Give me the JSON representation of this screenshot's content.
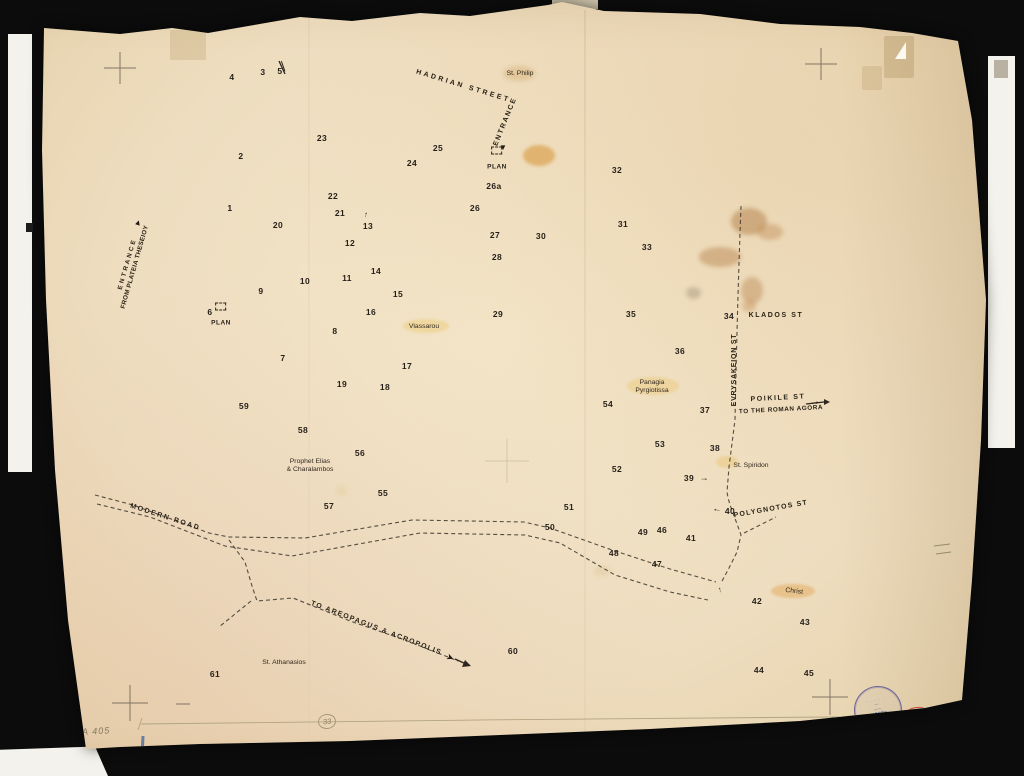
{
  "document": {
    "catalog_number": "A 405",
    "scale_circle_number": "33",
    "red_inventory_mark": "1-1",
    "stamp": {
      "bottom_text": "ATHENS",
      "handwritten_number": "1310a"
    }
  },
  "map": {
    "plan_label": "PLAN",
    "plan_markers": [
      {
        "name": "plan-marker-entrance",
        "x": 497,
        "y": 160
      },
      {
        "name": "plan-marker-6",
        "x": 221,
        "y": 316
      }
    ],
    "labels": [
      {
        "name": "street-label-hadrian",
        "kind": "street",
        "text": "HADRIAN STREET",
        "x": 463,
        "y": 87,
        "rot": 17,
        "ls": 2.6
      },
      {
        "name": "street-label-entrance-top",
        "kind": "street",
        "text": "ENTRANCE",
        "x": 506,
        "y": 122,
        "rot": -68,
        "ls": 1.6
      },
      {
        "name": "street-label-entrance-west",
        "kind": "street",
        "text": "E N T R A N C E\nFROM PLATEIA THESEIOY",
        "x": 131,
        "y": 266,
        "rot": -74,
        "ls": 0.3,
        "fs": 6.3
      },
      {
        "name": "street-label-klados",
        "kind": "street",
        "text": "KLADOS ST",
        "x": 776,
        "y": 316,
        "rot": 0,
        "ls": 1.6
      },
      {
        "name": "street-label-evrysakeion",
        "kind": "street",
        "text": "EVRYSAKEION ST",
        "x": 735,
        "y": 370,
        "rot": -90,
        "ls": 0.8
      },
      {
        "name": "street-label-poikile",
        "kind": "street",
        "text": "POIKILE ST",
        "x": 778,
        "y": 399,
        "rot": -3,
        "ls": 1.6
      },
      {
        "name": "street-label-to-roman-agora",
        "kind": "street",
        "text": "TO THE ROMAN AGORA",
        "x": 781,
        "y": 410,
        "rot": -3,
        "ls": 0.6,
        "fs": 6.3
      },
      {
        "name": "street-label-polygnotos",
        "kind": "street",
        "text": "POLYGNOTOS ST",
        "x": 771,
        "y": 510,
        "rot": -10,
        "ls": 1.2
      },
      {
        "name": "street-label-modern-road",
        "kind": "street",
        "text": "MODERN ROAD",
        "x": 165,
        "y": 518,
        "rot": 18,
        "ls": 1.8
      },
      {
        "name": "street-label-to-areopagus",
        "kind": "street",
        "text": "TO AREOPAGUS & ACROPOLIS",
        "x": 376,
        "y": 629,
        "rot": 21,
        "ls": 1.4
      },
      {
        "name": "church-label-st-philip",
        "kind": "church",
        "text": "St. Philip",
        "x": 520,
        "y": 74,
        "rot": 0
      },
      {
        "name": "church-label-vlassarou",
        "kind": "church",
        "text": "Vlassarou",
        "x": 424,
        "y": 327,
        "rot": 0
      },
      {
        "name": "church-label-panagia-pyrgiotissa",
        "kind": "church",
        "text": "Panagia\nPyrgiotissa",
        "x": 652,
        "y": 387,
        "rot": 0
      },
      {
        "name": "church-label-prophet-elias",
        "kind": "church",
        "text": "Prophet Elias\n& Charalambos",
        "x": 310,
        "y": 466,
        "rot": 0
      },
      {
        "name": "church-label-st-spiridon",
        "kind": "church",
        "text": "St. Spiridon",
        "x": 751,
        "y": 466,
        "rot": 0
      },
      {
        "name": "church-label-christ",
        "kind": "church",
        "text": "Christ",
        "x": 794,
        "y": 592,
        "rot": 7
      },
      {
        "name": "church-label-st-athanasios",
        "kind": "church",
        "text": "St. Athanasios",
        "x": 284,
        "y": 663,
        "rot": 0
      }
    ],
    "points": [
      {
        "n": "1",
        "x": 230,
        "y": 208
      },
      {
        "n": "2",
        "x": 241,
        "y": 156
      },
      {
        "n": "3",
        "x": 263,
        "y": 72
      },
      {
        "n": "4",
        "x": 232,
        "y": 77
      },
      {
        "n": "5",
        "x": 280,
        "y": 71
      },
      {
        "n": "6",
        "x": 210,
        "y": 312
      },
      {
        "n": "7",
        "x": 283,
        "y": 358
      },
      {
        "n": "8",
        "x": 335,
        "y": 331
      },
      {
        "n": "9",
        "x": 261,
        "y": 291
      },
      {
        "n": "10",
        "x": 305,
        "y": 281
      },
      {
        "n": "11",
        "x": 347,
        "y": 278
      },
      {
        "n": "12",
        "x": 350,
        "y": 243
      },
      {
        "n": "13",
        "x": 368,
        "y": 226
      },
      {
        "n": "14",
        "x": 376,
        "y": 271
      },
      {
        "n": "15",
        "x": 398,
        "y": 294
      },
      {
        "n": "16",
        "x": 371,
        "y": 312
      },
      {
        "n": "17",
        "x": 407,
        "y": 366
      },
      {
        "n": "18",
        "x": 385,
        "y": 387
      },
      {
        "n": "19",
        "x": 342,
        "y": 384
      },
      {
        "n": "20",
        "x": 278,
        "y": 225
      },
      {
        "n": "21",
        "x": 340,
        "y": 213
      },
      {
        "n": "22",
        "x": 333,
        "y": 196
      },
      {
        "n": "23",
        "x": 322,
        "y": 138
      },
      {
        "n": "24",
        "x": 412,
        "y": 163
      },
      {
        "n": "25",
        "x": 438,
        "y": 148
      },
      {
        "n": "26",
        "x": 475,
        "y": 208
      },
      {
        "n": "26a",
        "x": 494,
        "y": 186
      },
      {
        "n": "27",
        "x": 495,
        "y": 235
      },
      {
        "n": "28",
        "x": 497,
        "y": 257
      },
      {
        "n": "29",
        "x": 498,
        "y": 314
      },
      {
        "n": "30",
        "x": 541,
        "y": 236
      },
      {
        "n": "31",
        "x": 623,
        "y": 224
      },
      {
        "n": "32",
        "x": 617,
        "y": 170
      },
      {
        "n": "33",
        "x": 647,
        "y": 247
      },
      {
        "n": "34",
        "x": 729,
        "y": 316
      },
      {
        "n": "35",
        "x": 631,
        "y": 314
      },
      {
        "n": "36",
        "x": 680,
        "y": 351
      },
      {
        "n": "37",
        "x": 705,
        "y": 410
      },
      {
        "n": "38",
        "x": 715,
        "y": 448
      },
      {
        "n": "39",
        "x": 689,
        "y": 478
      },
      {
        "n": "40",
        "x": 730,
        "y": 511
      },
      {
        "n": "41",
        "x": 691,
        "y": 538
      },
      {
        "n": "42",
        "x": 757,
        "y": 601
      },
      {
        "n": "43",
        "x": 805,
        "y": 622
      },
      {
        "n": "44",
        "x": 759,
        "y": 670
      },
      {
        "n": "45",
        "x": 809,
        "y": 673
      },
      {
        "n": "46",
        "x": 662,
        "y": 530
      },
      {
        "n": "47",
        "x": 657,
        "y": 564
      },
      {
        "n": "48",
        "x": 614,
        "y": 553
      },
      {
        "n": "49",
        "x": 643,
        "y": 532
      },
      {
        "n": "50",
        "x": 550,
        "y": 527
      },
      {
        "n": "51",
        "x": 569,
        "y": 507
      },
      {
        "n": "52",
        "x": 617,
        "y": 469
      },
      {
        "n": "53",
        "x": 660,
        "y": 444
      },
      {
        "n": "54",
        "x": 608,
        "y": 404
      },
      {
        "n": "55",
        "x": 383,
        "y": 493
      },
      {
        "n": "56",
        "x": 360,
        "y": 453
      },
      {
        "n": "57",
        "x": 329,
        "y": 506
      },
      {
        "n": "58",
        "x": 303,
        "y": 430
      },
      {
        "n": "59",
        "x": 244,
        "y": 406
      },
      {
        "n": "60",
        "x": 513,
        "y": 651
      },
      {
        "n": "61",
        "x": 215,
        "y": 674
      }
    ],
    "arrows": [
      {
        "name": "entrance-top-arrow-icon",
        "glyph": "▼",
        "x": 503,
        "y": 148,
        "rot": 0,
        "size": 8
      },
      {
        "name": "entrance-west-arrow-icon",
        "glyph": "▲",
        "x": 138,
        "y": 223,
        "rot": 18,
        "size": 8
      },
      {
        "name": "point-13-arrow-icon",
        "glyph": "↑",
        "x": 366,
        "y": 215,
        "rot": 6,
        "size": 8
      },
      {
        "name": "point-39-arrow-icon",
        "glyph": "→",
        "x": 704,
        "y": 478,
        "rot": 0,
        "size": 9
      },
      {
        "name": "point-40-arrow-icon",
        "glyph": "←",
        "x": 717,
        "y": 509,
        "rot": 6,
        "size": 9
      },
      {
        "name": "poikile-arrow-icon",
        "glyph": "→",
        "x": 815,
        "y": 402,
        "rot": -3,
        "size": 11
      },
      {
        "name": "areopagus-arrow-icon",
        "glyph": "➤",
        "x": 450,
        "y": 658,
        "rot": 24,
        "size": 8
      },
      {
        "name": "boundary-arrow-icon",
        "glyph": "↑",
        "x": 720,
        "y": 590,
        "rot": -10,
        "size": 8
      },
      {
        "name": "point-5-tick-mark",
        "glyph": "╲",
        "x": 283,
        "y": 67,
        "rot": 8,
        "size": 8
      }
    ]
  }
}
